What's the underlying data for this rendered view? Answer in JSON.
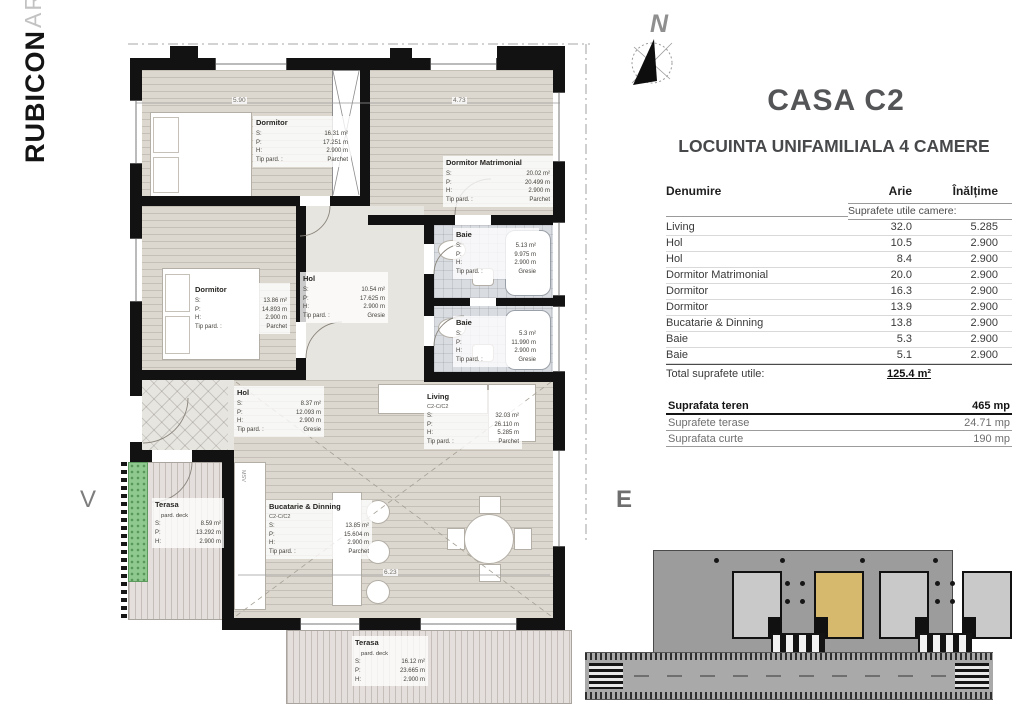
{
  "logo": {
    "primary": "RUBICON",
    "secondary": "ARCHITECTS"
  },
  "compass": {
    "label": "N"
  },
  "orientation": {
    "west_label": "V",
    "east_label": "E"
  },
  "header": {
    "title": "CASA C2",
    "subtitle": "LOCUINTA UNIFAMILIALA 4 CAMERE"
  },
  "spec_table": {
    "col_name": "Denumire",
    "col_area": "Arie",
    "col_height": "Înălțime",
    "section_label": "Suprafete utile camere:",
    "rows": [
      {
        "name": "Living",
        "area": "32.0",
        "height": "5.285"
      },
      {
        "name": "Hol",
        "area": "10.5",
        "height": "2.900"
      },
      {
        "name": "Hol",
        "area": "8.4",
        "height": "2.900"
      },
      {
        "name": "Dormitor Matrimonial",
        "area": "20.0",
        "height": "2.900"
      },
      {
        "name": "Dormitor",
        "area": "16.3",
        "height": "2.900"
      },
      {
        "name": "Dormitor",
        "area": "13.9",
        "height": "2.900"
      },
      {
        "name": "Bucatarie & Dinning",
        "area": "13.8",
        "height": "2.900"
      },
      {
        "name": "Baie",
        "area": "5.3",
        "height": "2.900"
      },
      {
        "name": "Baie",
        "area": "5.1",
        "height": "2.900"
      }
    ],
    "total_label": "Total suprafete utile:",
    "total_value": "125.4 m²"
  },
  "summary": {
    "rows": [
      {
        "label": "Suprafata teren",
        "value": "465 mp"
      },
      {
        "label": "Suprafete terase",
        "value": "24.71 mp"
      },
      {
        "label": "Suprafata curte",
        "value": "190 mp"
      }
    ]
  },
  "plan": {
    "labels": {
      "s": "S:",
      "p": "P:",
      "h": "H:",
      "tip": "Tip pard. :",
      "deck": "pard. deck"
    },
    "rooms": {
      "dormitor1": {
        "name": "Dormitor",
        "s": "16.31 m²",
        "p": "17.251 m",
        "h": "2.900 m",
        "tip": "Parchet"
      },
      "matrimonial": {
        "name": "Dormitor Matrimonial",
        "s": "20.02 m²",
        "p": "20.499 m",
        "h": "2.900 m",
        "tip": "Parchet"
      },
      "baie1": {
        "name": "Baie",
        "s": "5.13 m²",
        "p": "9.975 m",
        "h": "2.900 m",
        "tip": "Gresie"
      },
      "dormitor2": {
        "name": "Dormitor",
        "s": "13.86 m²",
        "p": "14.893 m",
        "h": "2.900 m",
        "tip": "Parchet"
      },
      "hol1": {
        "name": "Hol",
        "s": "10.54 m²",
        "p": "17.625 m",
        "h": "2.900 m",
        "tip": "Gresie"
      },
      "baie2": {
        "name": "Baie",
        "s": "5.3 m²",
        "p": "11.990 m",
        "h": "2.900 m",
        "tip": "Gresie"
      },
      "hol2": {
        "name": "Hol",
        "s": "8.37 m²",
        "p": "12.093 m",
        "h": "2.900 m",
        "tip": "Gresie"
      },
      "living": {
        "name": "Living",
        "code": "C2-C/C2",
        "s": "32.03 m²",
        "p": "26.110 m",
        "h": "5.285 m",
        "tip": "Parchet"
      },
      "bucatarie": {
        "name": "Bucatarie & Dinning",
        "code": "C2-C/C2",
        "s": "13.85 m²",
        "p": "15.604 m",
        "h": "2.900 m",
        "tip": "Parchet"
      },
      "terasa_vest": {
        "name": "Terasa",
        "s": "8.59 m²",
        "p": "13.292 m",
        "h": "2.900 m"
      },
      "terasa_sud": {
        "name": "Terasa",
        "s": "16.12 m²",
        "p": "23.665 m",
        "h": "2.900 m"
      }
    },
    "dimensions": {
      "d1": "5.90",
      "d2": "4.73",
      "d3": "6.23"
    },
    "appliance_label": "MSV"
  },
  "colors": {
    "wall": "#121212",
    "parquet_floor": "#dcd8d0",
    "bath_floor": "#d9dce1",
    "deck_floor": "#e4dfdc",
    "hedge_green": "#8fc98f",
    "highlighted_house": "#d7b96e"
  }
}
